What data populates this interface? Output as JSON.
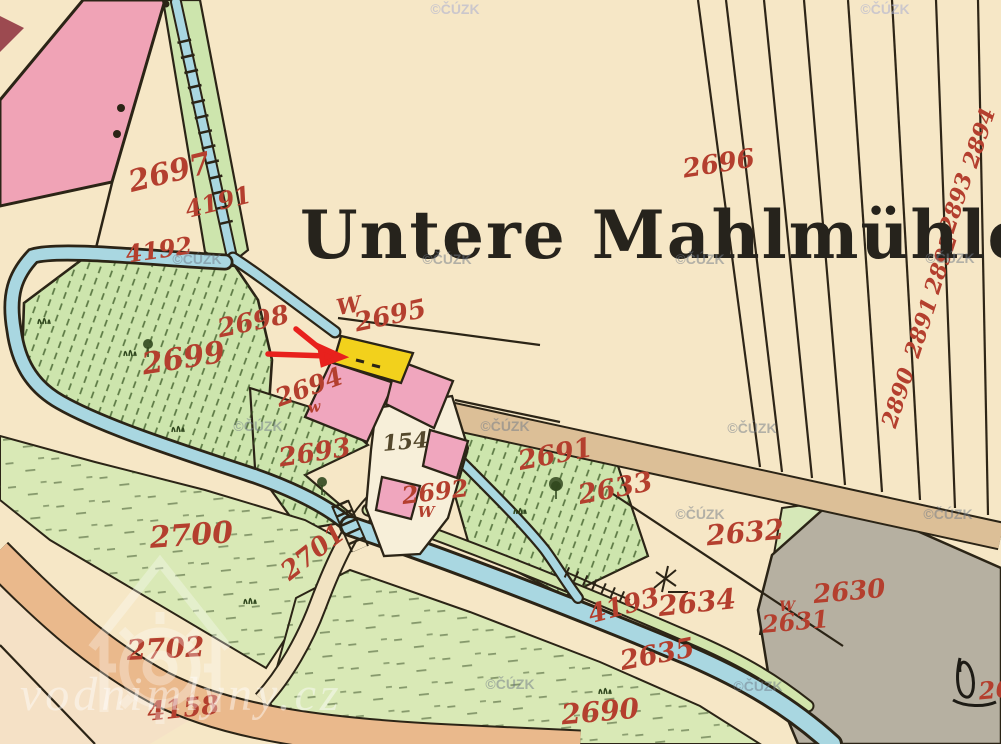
{
  "map": {
    "title": "Untere Mahlmühle"
  },
  "colors": {
    "paper": "#f6e7c6",
    "pink": "#f0a3b6",
    "darkred": "#9c4a50",
    "water": "#a9d7e1",
    "green": "#cde5ad",
    "green2": "#d9e9b6",
    "green3": "#d6e8b8",
    "road1": "#dcbf97",
    "road2": "#eab98c",
    "gray": "#b6b0a1",
    "yellow": "#f2d11c",
    "bpink": "#f0a6be",
    "court": "#f7efd9",
    "labelred": "#b43f2e",
    "arrow": "#e8211d",
    "ink": "#2b2416",
    "hatch": "#3d5c28",
    "wm": "#707a88",
    "wmblue": "#a9aed2",
    "wmwhite": "#ffffff"
  },
  "labels": [
    {
      "text": "2697",
      "x": 172,
      "y": 182,
      "rot": -14,
      "size": 30
    },
    {
      "text": "4191",
      "x": 220,
      "y": 210,
      "rot": -14,
      "size": 24
    },
    {
      "text": "4192",
      "x": 160,
      "y": 258,
      "rot": -8,
      "size": 24
    },
    {
      "text": "2696",
      "x": 720,
      "y": 172,
      "rot": -9,
      "size": 26
    },
    {
      "text": "2698",
      "x": 255,
      "y": 330,
      "rot": -12,
      "size": 26
    },
    {
      "text": "W",
      "x": 350,
      "y": 313,
      "rot": -10,
      "size": 22
    },
    {
      "text": "2695",
      "x": 392,
      "y": 324,
      "rot": -12,
      "size": 26
    },
    {
      "text": "2699",
      "x": 185,
      "y": 368,
      "rot": -9,
      "size": 30
    },
    {
      "text": "2694",
      "x": 312,
      "y": 395,
      "rot": -20,
      "size": 25
    },
    {
      "text": "w",
      "x": 315,
      "y": 412,
      "rot": -10,
      "size": 15
    },
    {
      "text": "2693",
      "x": 316,
      "y": 461,
      "rot": -9,
      "size": 26
    },
    {
      "text": "154",
      "x": 406,
      "y": 449,
      "rot": -5,
      "size": 22,
      "cls": "house"
    },
    {
      "text": "2691",
      "x": 557,
      "y": 463,
      "rot": -11,
      "size": 27
    },
    {
      "text": "2692",
      "x": 436,
      "y": 500,
      "rot": -7,
      "size": 24
    },
    {
      "text": "W",
      "x": 426,
      "y": 517,
      "rot": 0,
      "size": 15
    },
    {
      "text": "2633",
      "x": 617,
      "y": 497,
      "rot": -11,
      "size": 27
    },
    {
      "text": "2632",
      "x": 746,
      "y": 542,
      "rot": -5,
      "size": 28
    },
    {
      "text": "2630",
      "x": 850,
      "y": 600,
      "rot": -5,
      "size": 26
    },
    {
      "text": "W",
      "x": 787,
      "y": 611,
      "rot": 0,
      "size": 14
    },
    {
      "text": "2631",
      "x": 796,
      "y": 630,
      "rot": -5,
      "size": 24
    },
    {
      "text": "2634",
      "x": 698,
      "y": 612,
      "rot": -6,
      "size": 28
    },
    {
      "text": "4193",
      "x": 626,
      "y": 614,
      "rot": -15,
      "size": 26
    },
    {
      "text": "2635",
      "x": 659,
      "y": 663,
      "rot": -11,
      "size": 27
    },
    {
      "text": "2690",
      "x": 601,
      "y": 721,
      "rot": -5,
      "size": 28
    },
    {
      "text": "2700",
      "x": 192,
      "y": 545,
      "rot": -4,
      "size": 30
    },
    {
      "text": "2701",
      "x": 318,
      "y": 559,
      "rot": -38,
      "size": 26
    },
    {
      "text": "2702",
      "x": 166,
      "y": 658,
      "rot": -3,
      "size": 28
    },
    {
      "text": "4158",
      "x": 184,
      "y": 717,
      "rot": -6,
      "size": 26
    },
    {
      "text": "2894",
      "x": 986,
      "y": 140,
      "rot": -72,
      "size": 22
    },
    {
      "text": "2893",
      "x": 963,
      "y": 205,
      "rot": -72,
      "size": 22
    },
    {
      "text": "2892",
      "x": 948,
      "y": 266,
      "rot": -72,
      "size": 22
    },
    {
      "text": "2891",
      "x": 928,
      "y": 330,
      "rot": -72,
      "size": 22
    },
    {
      "text": "2890",
      "x": 905,
      "y": 400,
      "rot": -72,
      "size": 22
    },
    {
      "text": "26",
      "x": 996,
      "y": 698,
      "rot": -5,
      "size": 24
    }
  ],
  "watermarks": {
    "cuzk_text": "©ČÚZK",
    "cuzk_positions": [
      [
        455,
        14,
        "blue"
      ],
      [
        885,
        14,
        "blue"
      ],
      [
        197,
        264
      ],
      [
        447,
        264
      ],
      [
        700,
        264
      ],
      [
        950,
        263
      ],
      [
        258,
        431
      ],
      [
        505,
        431
      ],
      [
        752,
        433
      ],
      [
        700,
        519
      ],
      [
        948,
        519
      ],
      [
        510,
        689
      ],
      [
        758,
        691
      ]
    ],
    "site_text": "vodnimlyny.cz"
  }
}
